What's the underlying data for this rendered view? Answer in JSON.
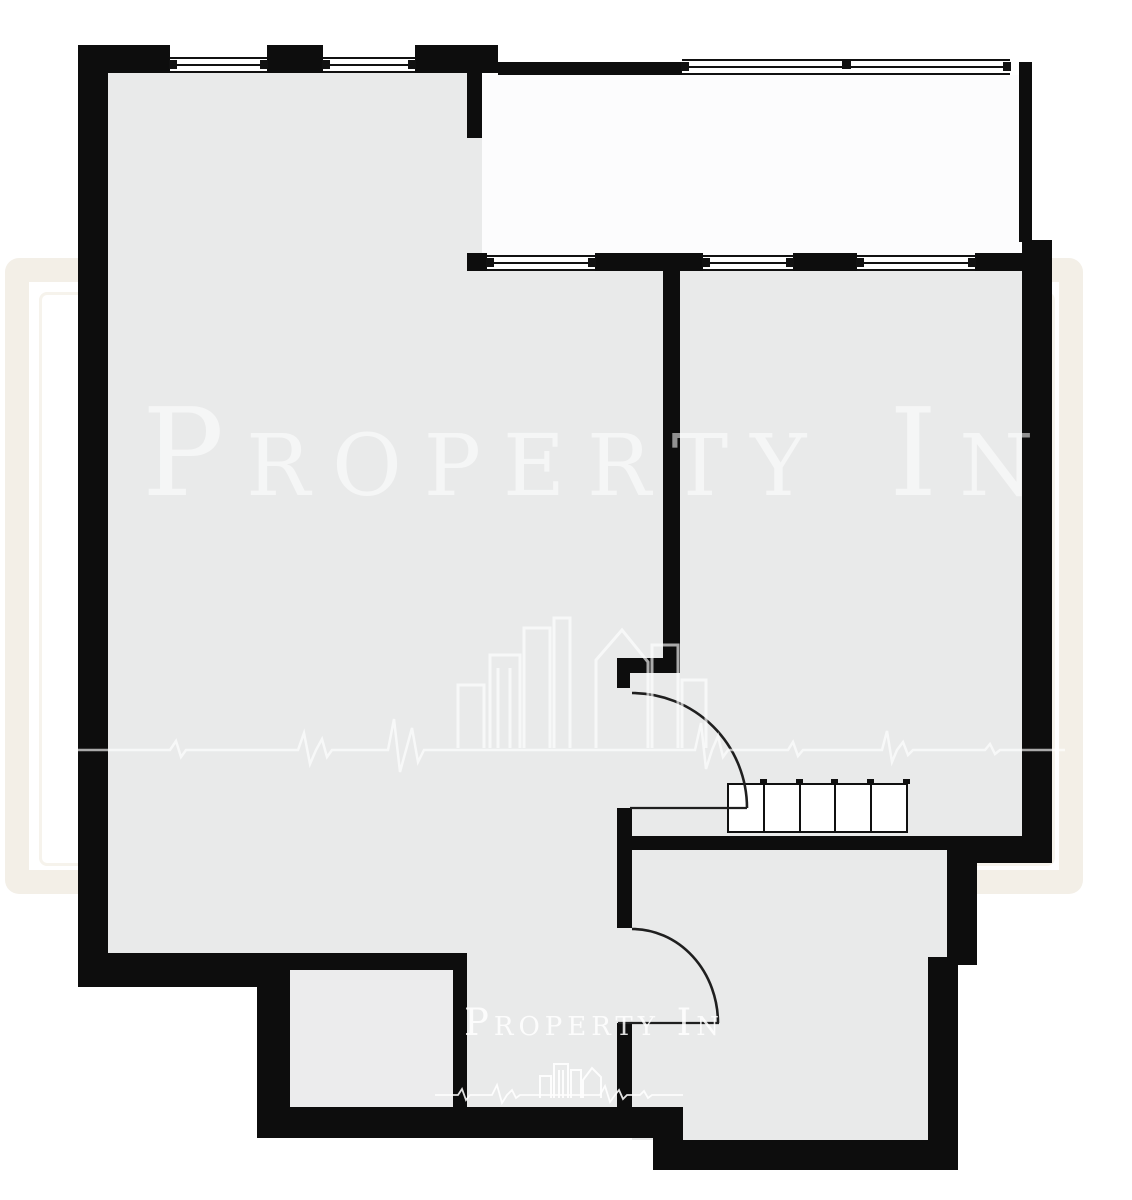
{
  "watermark": {
    "large_text": "Property In",
    "small_text": "Property In"
  },
  "wardrobe": {
    "cells": 5
  },
  "colors": {
    "wall": "#0d0d0d",
    "floor": "#e9eaea",
    "floor-closet": "#ececed",
    "balcony": "#fcfcfd",
    "frame": "#f3efe7",
    "frame-inner": "#f6f3ec",
    "window-line": "#111111",
    "door-line": "#1f1f1f",
    "wm-text": "rgba(255,255,255,0.55)",
    "wm-text-small": "rgba(255,255,255,0.85)",
    "wm-line": "rgba(255,255,255,0.65)"
  }
}
